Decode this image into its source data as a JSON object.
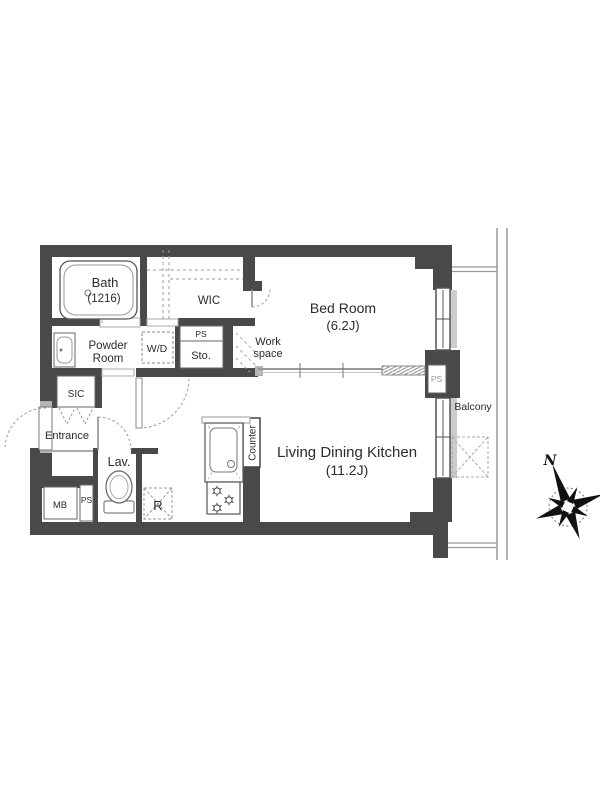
{
  "labels": {
    "bath": "Bath",
    "bath_size": "(1216)",
    "wic": "WIC",
    "bedroom": "Bed Room",
    "bedroom_size": "(6.2J)",
    "powder_line1": "Powder",
    "powder_line2": "Room",
    "washer_dryer": "W/D",
    "ps_storage": "PS",
    "storage": "Sto.",
    "work_line1": "Work",
    "work_line2": "space",
    "sic": "SIC",
    "entrance": "Entrance",
    "lavatory": "Lav.",
    "meter_box": "MB",
    "ps_meter": "PS",
    "refrigerator": "R",
    "counter": "Counter",
    "ldk": "Living Dining Kitchen",
    "ldk_size": "(11.2J)",
    "balcony": "Balcony",
    "ps_shaft": "PS",
    "compass_north": "N"
  },
  "colors": {
    "wall": "#4a484b",
    "line_gray": "#999999",
    "accent_gray": "#b4b4b4",
    "text": "#2b2b2b"
  }
}
